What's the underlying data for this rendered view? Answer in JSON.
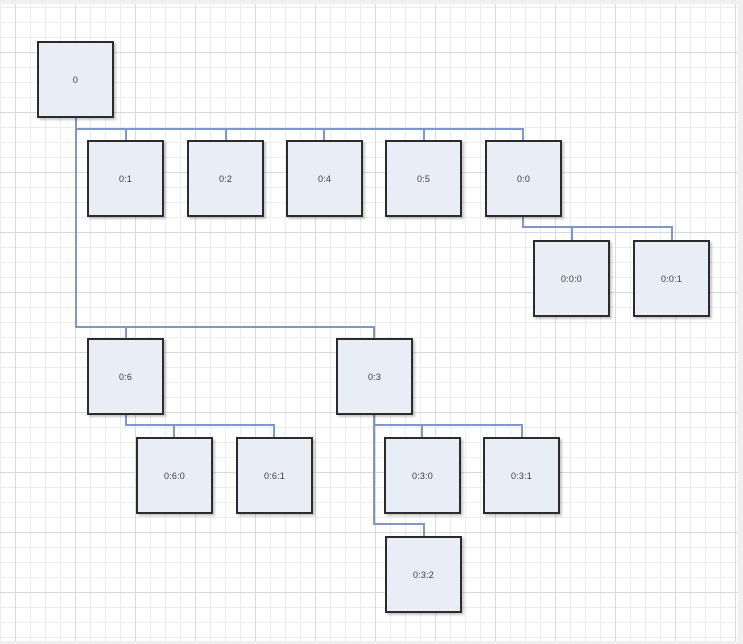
{
  "app": {
    "surface": "diagram-canvas",
    "colors": {
      "page_edge": "#f0f0f0",
      "canvas_bg": "#ffffff",
      "grid_minor": "#ececec",
      "grid_major": "#d9d9d9",
      "node_fill": "#e9edf6",
      "node_border": "#2b2b2b",
      "node_text": "#3b3b3b",
      "connector": "#7e96c8"
    }
  },
  "diagram": {
    "type": "tree",
    "nodes": [
      {
        "id": "0",
        "label": "0",
        "x": 37,
        "y": 41,
        "w": 77,
        "h": 77
      },
      {
        "id": "0:1",
        "label": "0:1",
        "x": 87,
        "y": 140,
        "w": 77,
        "h": 77
      },
      {
        "id": "0:2",
        "label": "0:2",
        "x": 187,
        "y": 140,
        "w": 77,
        "h": 77
      },
      {
        "id": "0:4",
        "label": "0:4",
        "x": 286,
        "y": 140,
        "w": 77,
        "h": 77
      },
      {
        "id": "0:5",
        "label": "0:5",
        "x": 385,
        "y": 140,
        "w": 77,
        "h": 77
      },
      {
        "id": "0:0",
        "label": "0:0",
        "x": 485,
        "y": 140,
        "w": 77,
        "h": 77
      },
      {
        "id": "0:0:0",
        "label": "0:0:0",
        "x": 533,
        "y": 240,
        "w": 77,
        "h": 77
      },
      {
        "id": "0:0:1",
        "label": "0:0:1",
        "x": 633,
        "y": 240,
        "w": 77,
        "h": 77
      },
      {
        "id": "0:6",
        "label": "0:6",
        "x": 87,
        "y": 338,
        "w": 77,
        "h": 77
      },
      {
        "id": "0:3",
        "label": "0:3",
        "x": 336,
        "y": 338,
        "w": 77,
        "h": 77
      },
      {
        "id": "0:6:0",
        "label": "0:6:0",
        "x": 136,
        "y": 437,
        "w": 77,
        "h": 77
      },
      {
        "id": "0:6:1",
        "label": "0:6:1",
        "x": 236,
        "y": 437,
        "w": 77,
        "h": 77
      },
      {
        "id": "0:3:0",
        "label": "0:3:0",
        "x": 384,
        "y": 437,
        "w": 77,
        "h": 77
      },
      {
        "id": "0:3:1",
        "label": "0:3:1",
        "x": 483,
        "y": 437,
        "w": 77,
        "h": 77
      },
      {
        "id": "0:3:2",
        "label": "0:3:2",
        "x": 385,
        "y": 536,
        "w": 77,
        "h": 77
      }
    ],
    "edges": [
      {
        "name": "trunk-0-to-row3",
        "points": [
          [
            76,
            118
          ],
          [
            76,
            327
          ]
        ]
      },
      {
        "name": "rail-0-children",
        "points": [
          [
            76,
            129
          ],
          [
            523,
            129
          ],
          [
            523,
            140
          ]
        ]
      },
      {
        "name": "stub-0-1",
        "points": [
          [
            126,
            129
          ],
          [
            126,
            140
          ]
        ]
      },
      {
        "name": "stub-0-2",
        "points": [
          [
            226,
            129
          ],
          [
            226,
            140
          ]
        ]
      },
      {
        "name": "stub-0-4",
        "points": [
          [
            324,
            129
          ],
          [
            324,
            140
          ]
        ]
      },
      {
        "name": "stub-0-5",
        "points": [
          [
            424,
            129
          ],
          [
            424,
            140
          ]
        ]
      },
      {
        "name": "rail-0-0-children",
        "points": [
          [
            523,
            217
          ],
          [
            523,
            227
          ],
          [
            672,
            227
          ],
          [
            672,
            240
          ]
        ]
      },
      {
        "name": "stub-0-0-0",
        "points": [
          [
            572,
            227
          ],
          [
            572,
            240
          ]
        ]
      },
      {
        "name": "rail-0-row3",
        "points": [
          [
            76,
            327
          ],
          [
            374,
            327
          ],
          [
            374,
            338
          ]
        ]
      },
      {
        "name": "stub-0-6",
        "points": [
          [
            126,
            327
          ],
          [
            126,
            338
          ]
        ]
      },
      {
        "name": "rail-0-6-children",
        "points": [
          [
            126,
            415
          ],
          [
            126,
            425
          ],
          [
            274,
            425
          ],
          [
            274,
            437
          ]
        ]
      },
      {
        "name": "stub-0-6-0",
        "points": [
          [
            174,
            425
          ],
          [
            174,
            437
          ]
        ]
      },
      {
        "name": "rail-0-3-children",
        "points": [
          [
            374,
            415
          ],
          [
            374,
            425
          ],
          [
            522,
            425
          ],
          [
            522,
            437
          ]
        ]
      },
      {
        "name": "stub-0-3-0",
        "points": [
          [
            422,
            425
          ],
          [
            422,
            437
          ]
        ]
      },
      {
        "name": "rail-0-3-2",
        "points": [
          [
            374,
            425
          ],
          [
            374,
            524
          ],
          [
            424,
            524
          ],
          [
            424,
            536
          ]
        ]
      }
    ]
  }
}
